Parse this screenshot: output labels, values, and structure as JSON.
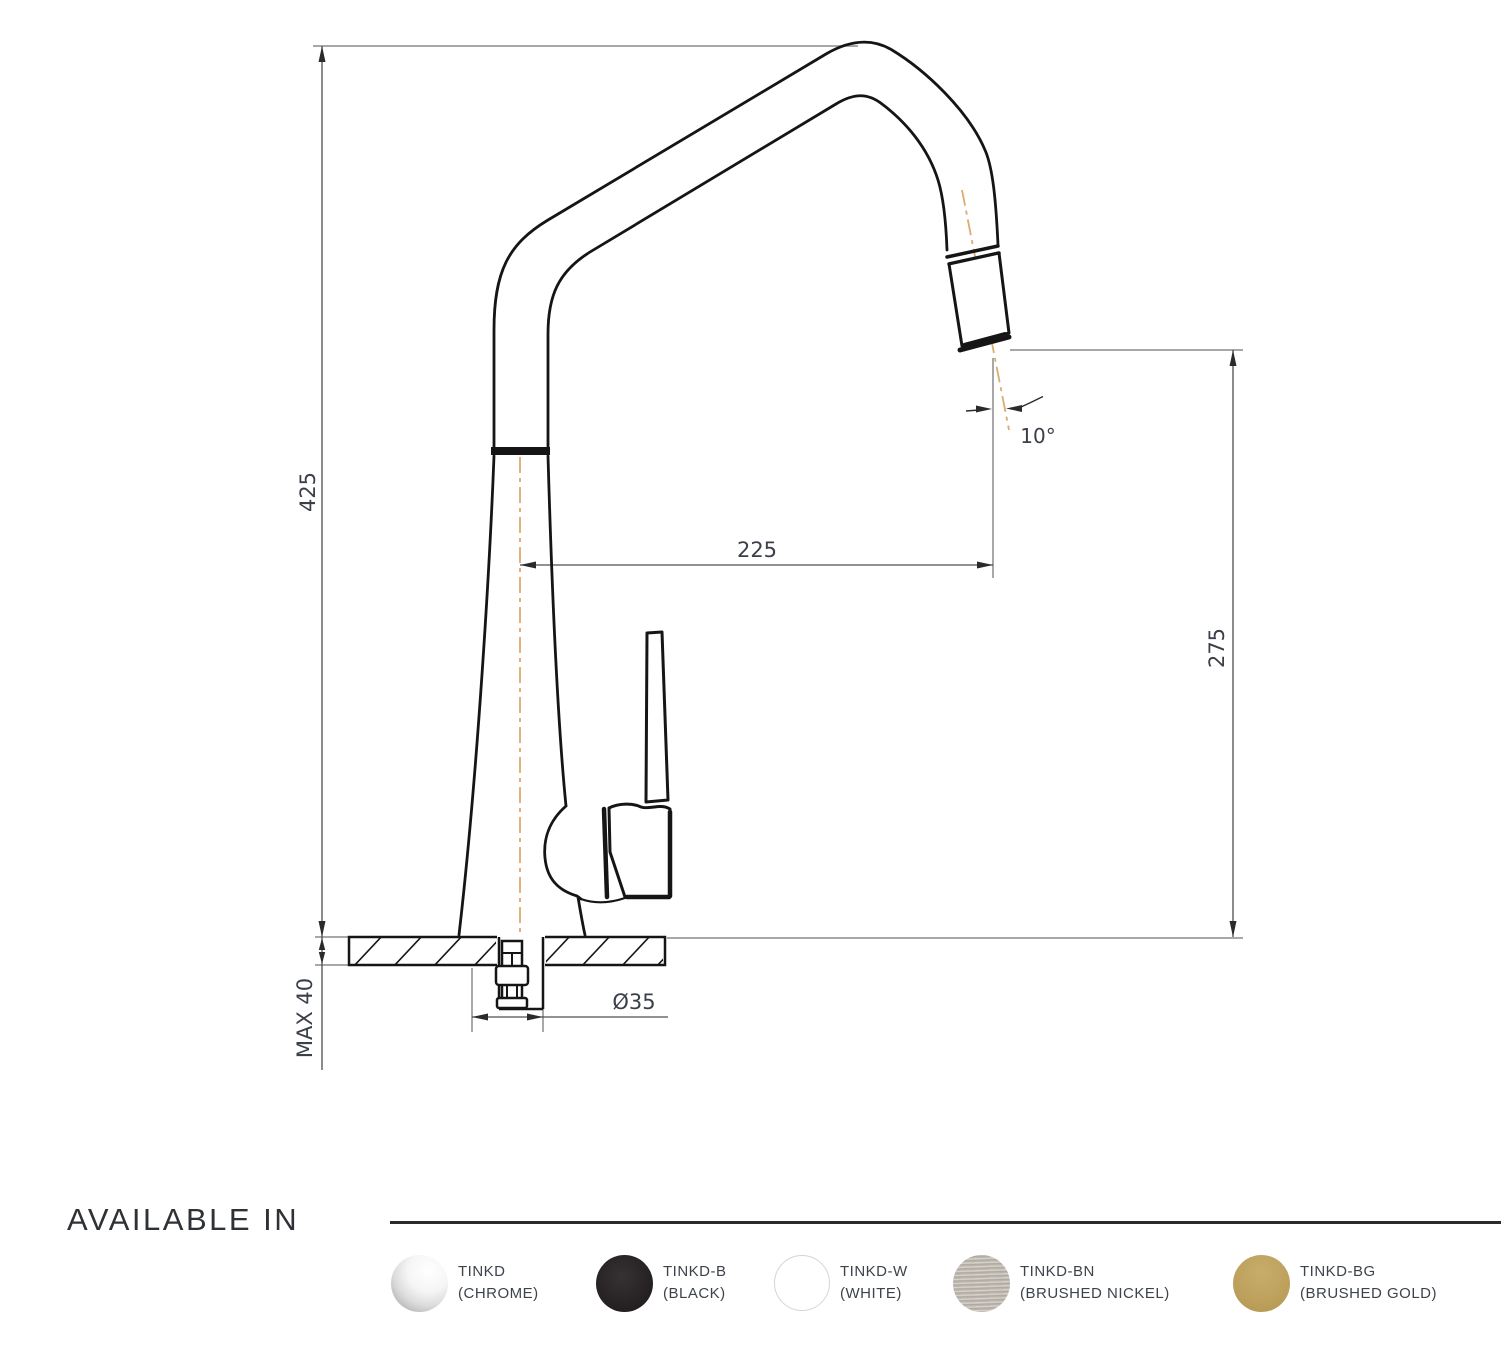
{
  "diagram": {
    "dimensions": {
      "overall_height": "425",
      "spout_reach": "225",
      "spout_height": "275",
      "spray_angle": "10°",
      "hole_diameter": "Ø35",
      "max_counter_thickness": "MAX 40"
    },
    "colors": {
      "outline": "#151515",
      "dimension_line": "#4f4f4f",
      "extension_line": "#8c8c8c",
      "centerline": "#dcab70",
      "dimension_text": "#3a3f48"
    }
  },
  "available_in": {
    "title": "AVAILABLE IN",
    "finishes": [
      {
        "code": "TINKD",
        "name": "(CHROME)",
        "color": "#d9d9d9"
      },
      {
        "code": "TINKD-B",
        "name": "(BLACK)",
        "color": "#242021"
      },
      {
        "code": "TINKD-W",
        "name": "(WHITE)",
        "color": "#ffffff"
      },
      {
        "code": "TINKD-BN",
        "name": "(BRUSHED NICKEL)",
        "color": "#b9b3aa"
      },
      {
        "code": "TINKD-BG",
        "name": "(BRUSHED GOLD)",
        "color": "#bda05c"
      }
    ]
  }
}
